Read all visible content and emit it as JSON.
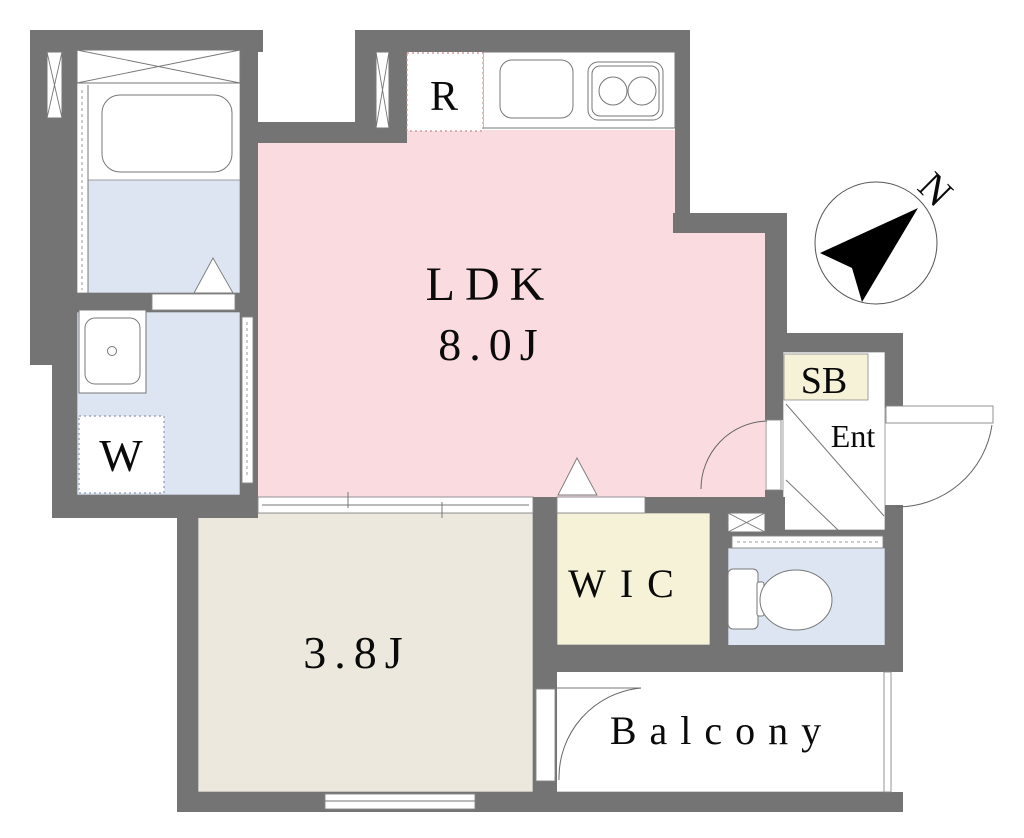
{
  "title": "apartment-floor-plan",
  "labels": {
    "ldk": "LDK",
    "ldk_size": "8.0J",
    "bedroom_size": "3.8J",
    "wic": "WIC",
    "balcony": "Balcony",
    "washer": "W",
    "refrigerator": "R",
    "shoe_box": "SB",
    "entrance": "Ent",
    "north": "N"
  },
  "colors": {
    "wall": "#747474",
    "ldk": "#fadce0",
    "wet": "#dde5f3",
    "cream": "#f5f2d8",
    "bedroom": "#ece8dd",
    "line": "#777777",
    "fridge_dot": "#cc8888",
    "washer_dot": "#8b96ad"
  }
}
